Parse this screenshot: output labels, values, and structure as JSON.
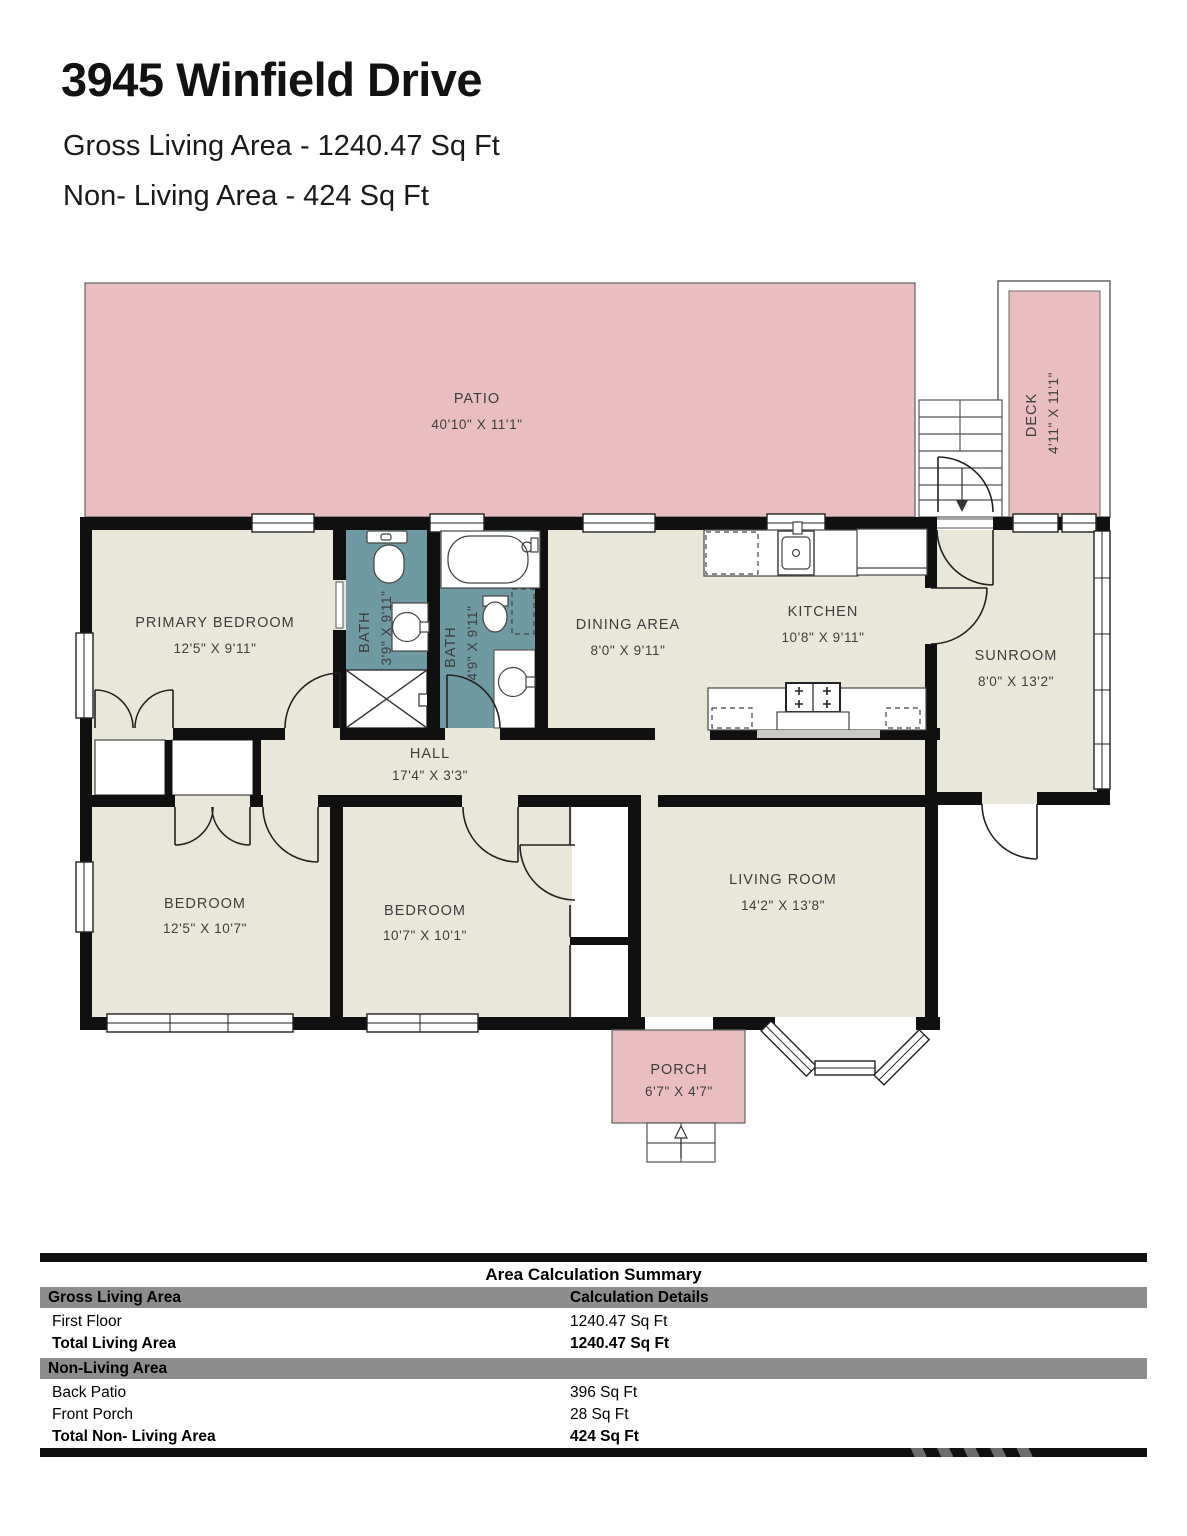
{
  "header": {
    "title": "3945 Winfield Drive",
    "subtitle1": "Gross Living Area - 1240.47 Sq Ft",
    "subtitle2": "Non- Living Area - 424 Sq Ft"
  },
  "rooms": {
    "patio": {
      "label": "PATIO",
      "dims": "40'10\" X 11'1\""
    },
    "deck": {
      "label": "DECK",
      "dims": "4'11\" X 11'1\""
    },
    "primary_bedroom": {
      "label": "PRIMARY BEDROOM",
      "dims": "12'5\" X 9'11\""
    },
    "bath1": {
      "label": "BATH",
      "dims": "3'9\" X 9'11\""
    },
    "bath2": {
      "label": "BATH",
      "dims": "4'9\" X 9'11\""
    },
    "dining": {
      "label": "DINING AREA",
      "dims": "8'0\" X 9'11\""
    },
    "kitchen": {
      "label": "KITCHEN",
      "dims": "10'8\" X 9'11\""
    },
    "sunroom": {
      "label": "SUNROOM",
      "dims": "8'0\" X 13'2\""
    },
    "hall": {
      "label": "HALL",
      "dims": "17'4\" X 3'3\""
    },
    "bedroom1": {
      "label": "BEDROOM",
      "dims": "12'5\" X 10'7\""
    },
    "bedroom2": {
      "label": "BEDROOM",
      "dims": "10'7\" X 10'1\""
    },
    "living_room": {
      "label": "LIVING ROOM",
      "dims": "14'2\" X 13'8\""
    },
    "porch": {
      "label": "PORCH",
      "dims": "6'7\" X 4'7\""
    }
  },
  "colors": {
    "outdoor_pink": "#e9bec1",
    "room_beige": "#e9e7da",
    "bath_teal": "#6f99a3",
    "wall_black": "#101010",
    "table_band_gray": "#8d8d8d"
  },
  "summary": {
    "title": "Area Calculation Summary",
    "section1_header": "Gross Living Area",
    "details_header": "Calculation Details",
    "rows": [
      {
        "label": "First Floor",
        "value": "1240.47 Sq Ft"
      },
      {
        "label": "Total Living Area",
        "value": "1240.47 Sq Ft"
      }
    ],
    "section2_header": "Non-Living Area",
    "rows2": [
      {
        "label": "Back Patio",
        "value": "396 Sq Ft"
      },
      {
        "label": "Front Porch",
        "value": "28 Sq Ft"
      },
      {
        "label": "Total Non- Living Area",
        "value": "424 Sq Ft"
      }
    ]
  }
}
